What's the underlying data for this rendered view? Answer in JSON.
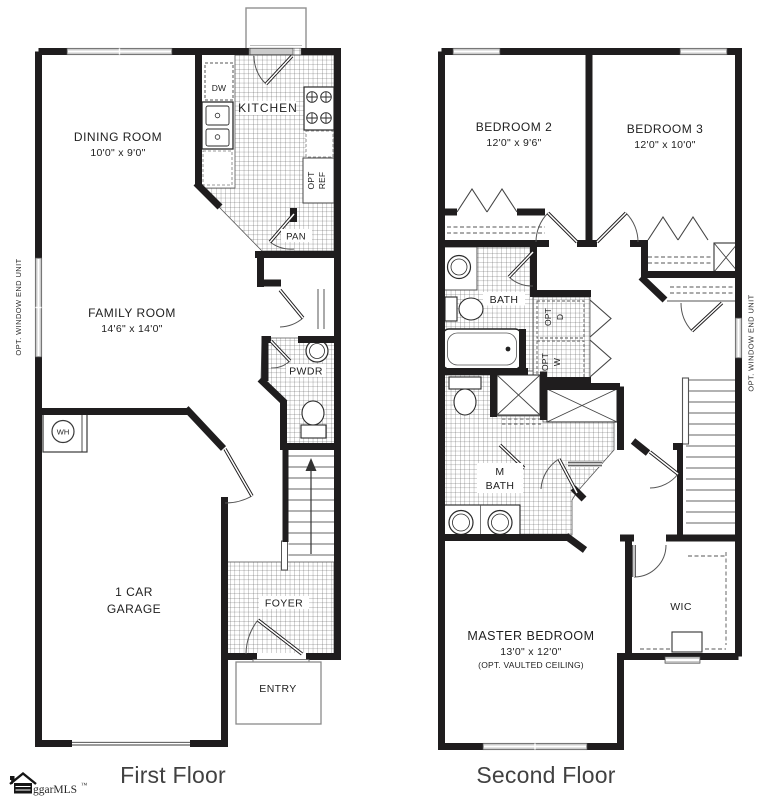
{
  "colors": {
    "wall": "#1f1d1e",
    "tile_line": "#4f4f4f",
    "window_fill": "#cbcbcb",
    "label_text": "#1e1e1e",
    "title_text": "#414141"
  },
  "first_floor": {
    "title": "First Floor",
    "labels": {
      "dining_name": "DINING ROOM",
      "dining_dims": "10'0\" x 9'0\"",
      "kitchen": "KITCHEN",
      "dishwasher": "DW",
      "opt_ref_1": "OPT",
      "opt_ref_2": "REF",
      "pantry": "PAN",
      "family_name": "FAMILY ROOM",
      "family_dims": "14'6\" x 14'0\"",
      "powder": "PWDR",
      "water_heater": "WH",
      "garage_1": "1 CAR",
      "garage_2": "GARAGE",
      "foyer": "FOYER",
      "entry": "ENTRY",
      "side_note": "OPT. WINDOW END UNIT"
    }
  },
  "second_floor": {
    "title": "Second Floor",
    "labels": {
      "bedroom2_name": "BEDROOM 2",
      "bedroom2_dims": "12'0\" x 9'6\"",
      "bedroom3_name": "BEDROOM 3",
      "bedroom3_dims": "12'0\" x 10'0\"",
      "bath": "BATH",
      "mbath_1": "M",
      "mbath_2": "BATH",
      "opt_d_1": "OPT",
      "opt_d_2": "D",
      "opt_w_1": "OPT",
      "opt_w_2": "W",
      "master_name": "MASTER BEDROOM",
      "master_dims": "13'0\" x 12'0\"",
      "master_note": "(OPT. VAULTED CEILING)",
      "wic": "WIC",
      "side_note": "OPT. WINDOW END UNIT"
    }
  },
  "watermark": {
    "text": "ggarMLS",
    "tm": "™"
  }
}
